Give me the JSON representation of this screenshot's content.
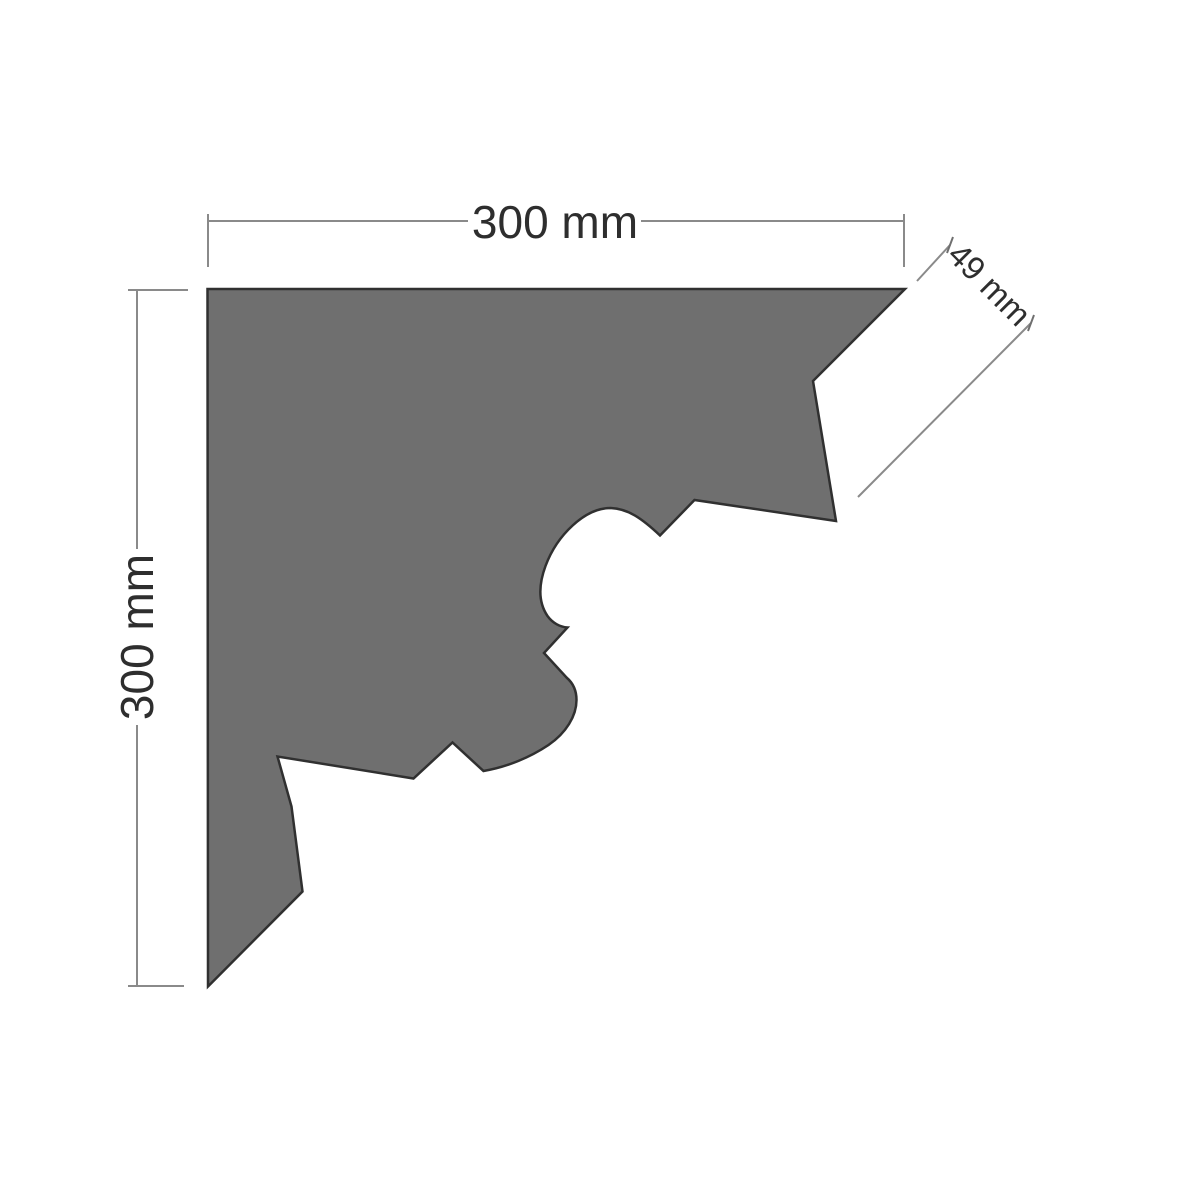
{
  "diagram": {
    "name": "cornice-profile-technical-drawing",
    "unit": "mm",
    "labels": {
      "top_width": "300 mm",
      "left_height": "300 mm",
      "fascia_drop": "49 mm"
    },
    "dimensions": {
      "width_mm": 300,
      "height_mm": 300,
      "fascia_mm": 49
    },
    "colors": {
      "background": "#ffffff",
      "shape_fill": "#6f6f6f",
      "shape_stroke": "#303030",
      "dimension_line": "#8a8a8a",
      "label_text": "#2e2e2e"
    }
  }
}
